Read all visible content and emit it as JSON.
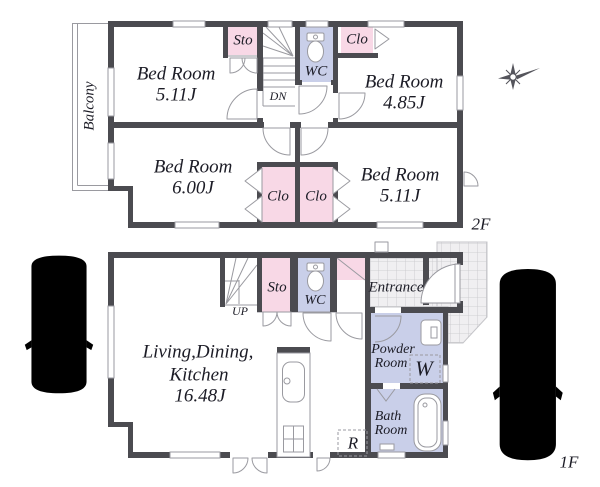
{
  "floor2": {
    "floor_label": "2F",
    "balcony_label": "Balcony",
    "bedroom_tl": {
      "name": "Bed Room",
      "size": "5.11J"
    },
    "bedroom_tr": {
      "name": "Bed Room",
      "size": "4.85J"
    },
    "bedroom_bl": {
      "name": "Bed Room",
      "size": "6.00J"
    },
    "bedroom_br": {
      "name": "Bed Room",
      "size": "5.11J"
    },
    "storage_label": "Sto",
    "wc_label": "WC",
    "closet_top_label": "Clo",
    "closet_left_label": "Clo",
    "closet_right_label": "Clo",
    "stairs_label": "DN"
  },
  "floor1": {
    "floor_label": "1F",
    "ldk": {
      "line1": "Living,Dining,",
      "line2": "Kitchen",
      "size": "16.48J"
    },
    "storage_label": "Sto",
    "wc_label": "WC",
    "entrance_label": "Entrance",
    "powder_room": {
      "line1": "Powder",
      "line2": "Room"
    },
    "bath_room": {
      "line1": "Bath",
      "line2": "Room"
    },
    "washer_label": "W",
    "fridge_label": "R",
    "stairs_label": "UP"
  },
  "colors": {
    "wall": "#4b4b50",
    "closet_pink": "#f8d8e6",
    "sanitary_blue": "#c9cfe9",
    "fixture_line": "#9a9aa0",
    "text": "#1c1c26",
    "tile_line": "#c6c6ca"
  }
}
